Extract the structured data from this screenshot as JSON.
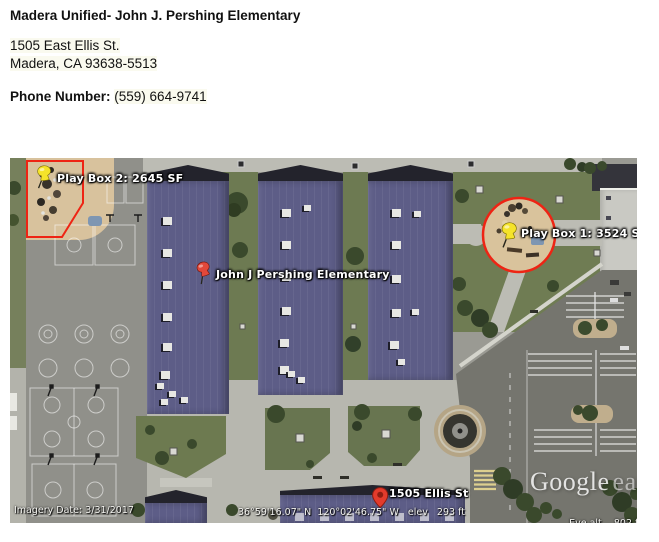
{
  "header": {
    "title": "Madera Unified- John J. Pershing Elementary",
    "address_line1": "1505 East Ellis St.",
    "address_line2": "Madera, CA 93638-5513",
    "phone_label": "Phone Number:",
    "phone_value": "(559) 664-9741"
  },
  "map": {
    "pins": {
      "play_box_2": {
        "label": "Play Box 2: 2645 SF"
      },
      "play_box_1": {
        "label": "Play Box 1: 3524 SF"
      },
      "school": {
        "label": "John J Pershing Elementary"
      },
      "street": {
        "label": "1505 Ellis St"
      }
    },
    "status": {
      "imagery_date": "Imagery Date: 3/31/2017",
      "coordinates": "36°59'16.07\" N  120°02'46.75\" W   elev   293 ft",
      "eye_alt_label": "Eye alt",
      "eye_alt_value": "802 ft"
    },
    "logo": {
      "google": "Google",
      "earth": "earth"
    },
    "colors": {
      "roof_purple": "#5d5d87",
      "outline_red": "#ee2414",
      "pin_yellow": "#f5e32a",
      "pin_red": "#e2483a"
    }
  }
}
